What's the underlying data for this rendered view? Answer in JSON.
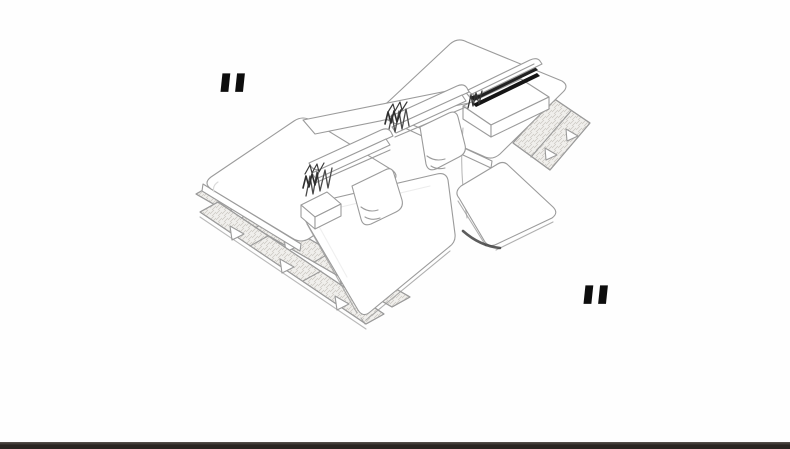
{
  "canvas": {
    "background_color": "#fefefe",
    "width_px": 790,
    "height_px": 449
  },
  "quote_decoration": {
    "open_glyph": "\"",
    "close_glyph": "\"",
    "color": "#0d0d0d"
  },
  "illustration": {
    "name": "modular-sofa-sketch",
    "description": "Light pencil-style isometric line drawing of a modular sofa and daybed set: two large mattress platforms, two cushioned backrest units with scribbled dark ends and leaning pillows, low seat slabs, and patterned rug strips with triangular tassels along the lower-left and right edges.",
    "line_color": "#9b9b9b",
    "dark_accent_color": "#222222",
    "texture_color": "#f0efec"
  },
  "footer_bar": {
    "color": "#2a2522",
    "height_px": 7
  }
}
